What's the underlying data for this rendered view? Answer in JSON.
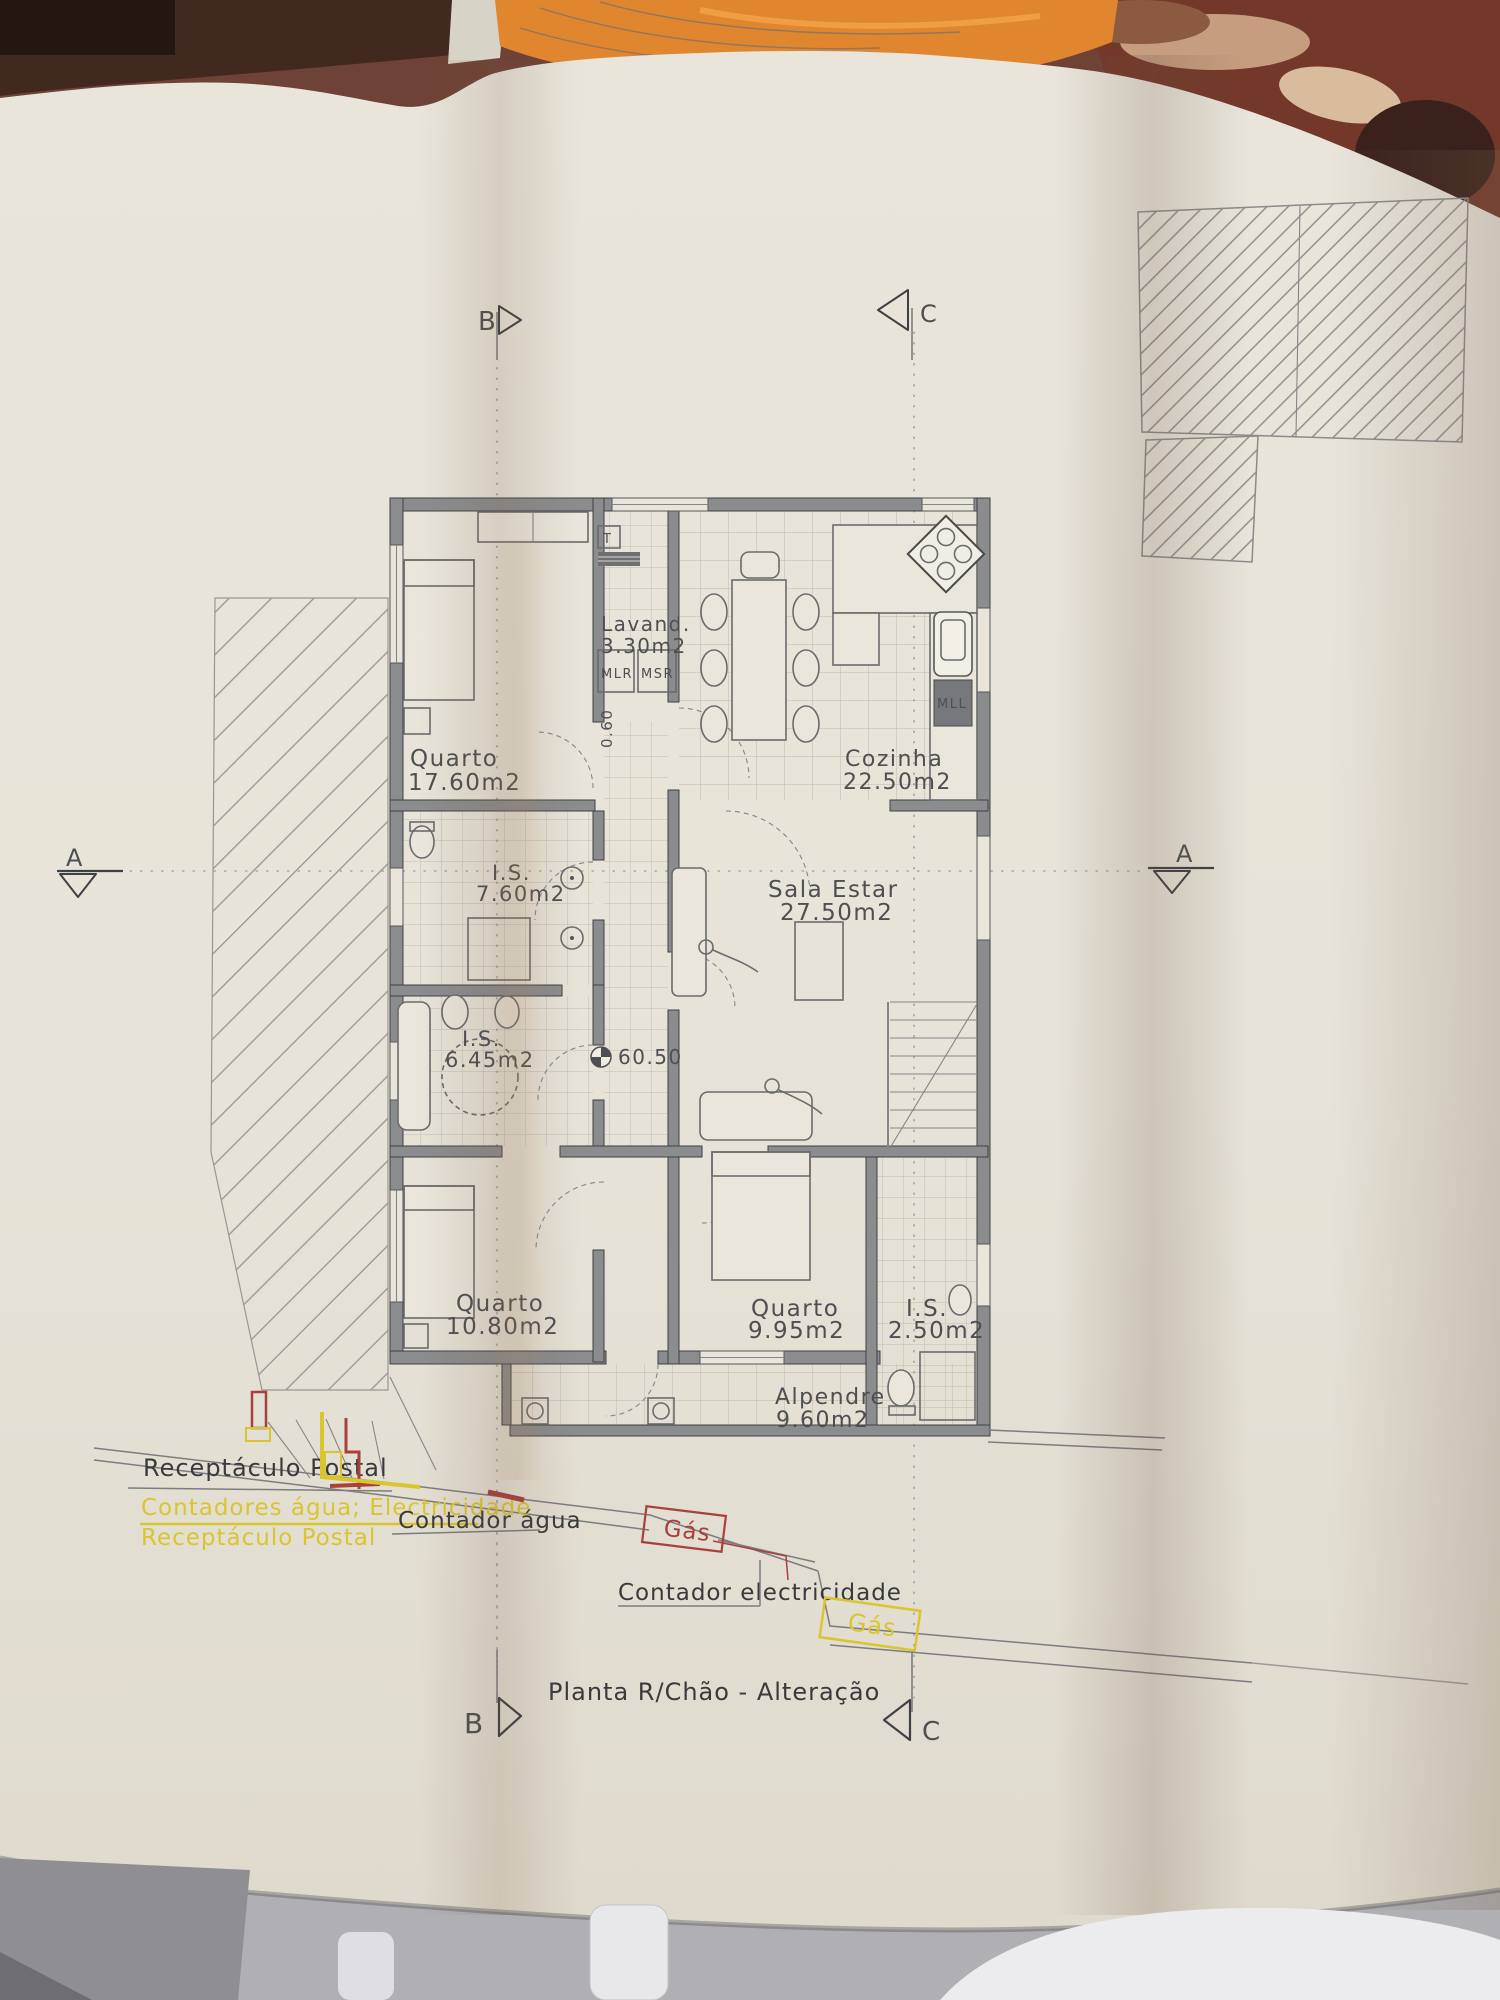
{
  "title": "Planta R/Chão - Alteração",
  "section_markers": {
    "a_left": "A",
    "a_right": "A",
    "b_top": "B",
    "b_bottom": "B",
    "c_top": "C",
    "c_bottom": "C"
  },
  "rooms": [
    {
      "name": "Quarto",
      "area": "17.60m2"
    },
    {
      "name": "Lavand.",
      "area": "3.30m2"
    },
    {
      "name": "Cozinha",
      "area": "22.50m2"
    },
    {
      "name": "I.S.",
      "area": "7.60m2"
    },
    {
      "name": "Sala Estar",
      "area": "27.50m2"
    },
    {
      "name": "I.S.",
      "area": "6.45m2"
    },
    {
      "name": "Quarto",
      "area": "10.80m2"
    },
    {
      "name": "Quarto",
      "area": "9.95m2"
    },
    {
      "name": "I.S.",
      "area": "2.50m2"
    },
    {
      "name": "Alpendre",
      "area": "9.60m2"
    }
  ],
  "levels": {
    "floor_level": "60.50",
    "threshold": "0.60"
  },
  "appliances": {
    "water_heater": "T",
    "washer": "MLR",
    "dryer": "MSR",
    "dishwasher": "MLL"
  },
  "annotations": {
    "receptaculo_postal": "Receptáculo Postal",
    "contadores": "Contadores água; Electricidade",
    "receptaculo_postal_2": "Receptáculo Postal",
    "contador_agua": "Contador água",
    "gas_1": "Gás",
    "contador_electricidade": "Contador electricidade",
    "gas_2": "Gás"
  },
  "colors": {
    "paper": "#e7e3d8",
    "drawing_ink": "#4e4f53",
    "wall_gray": "#8b8c8e",
    "annotation_yellow": "#d9c52e",
    "annotation_red": "#a8403c",
    "towel_orange": "#e0862e",
    "table_brown": "#6b4034"
  }
}
